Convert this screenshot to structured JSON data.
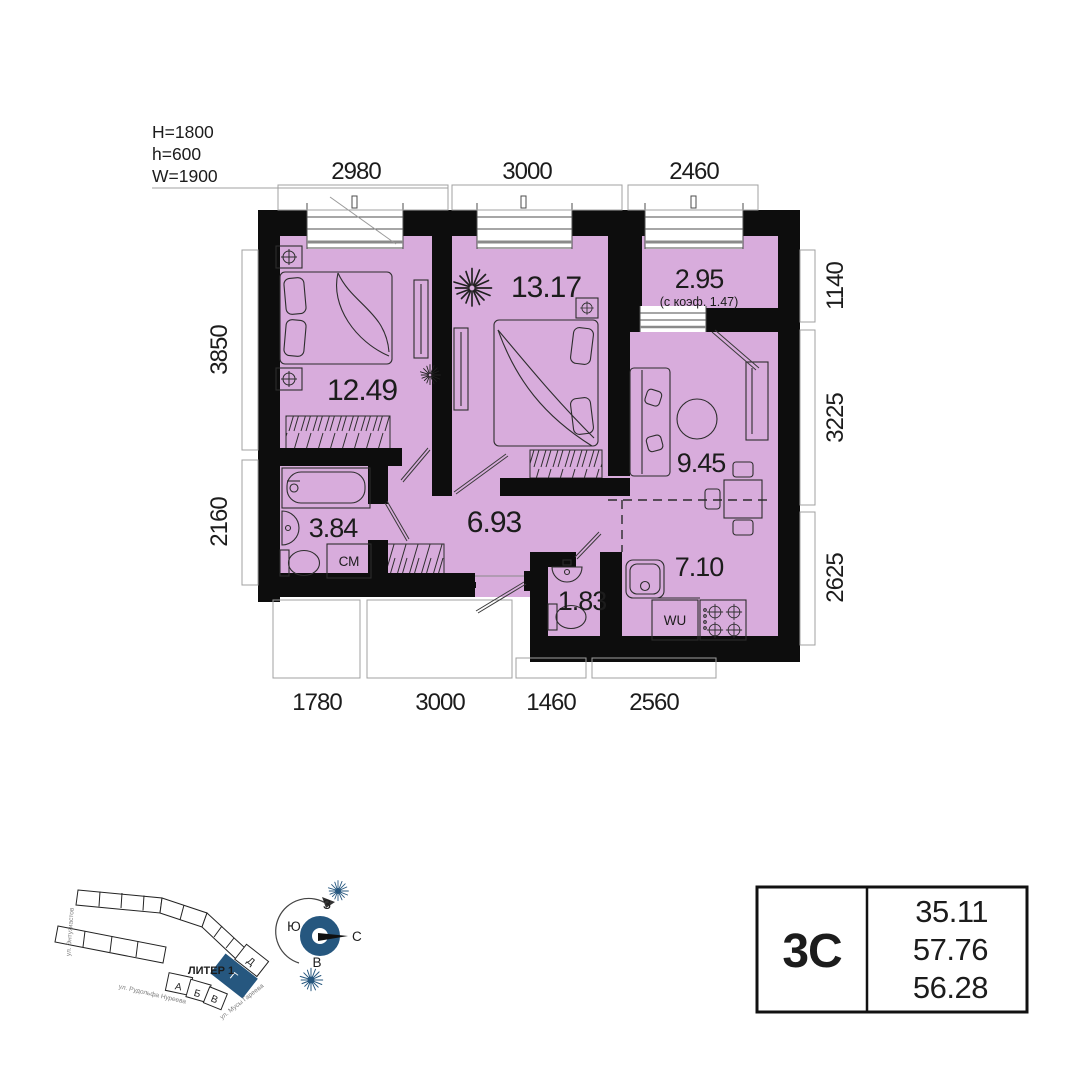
{
  "window_specs": {
    "l1": "H=1800",
    "l2": "h=600",
    "l3": "W=1900"
  },
  "dims": {
    "top": [
      "2980",
      "3000",
      "2460"
    ],
    "bottom": [
      "1780",
      "3000",
      "1460",
      "2560"
    ],
    "left": [
      "3850",
      "2160"
    ],
    "right": [
      "1140",
      "3225",
      "2625"
    ]
  },
  "rooms": {
    "bedroom1": {
      "area": "12.49"
    },
    "bedroom2": {
      "area": "13.17"
    },
    "balcony": {
      "area": "2.95",
      "note": "(с коэф. 1.47)"
    },
    "living": {
      "area": "9.45"
    },
    "hall": {
      "area": "6.93"
    },
    "bathroom": {
      "area": "3.84",
      "appliance": "СМ"
    },
    "wc": {
      "area": "1.83"
    },
    "kitchen": {
      "area": "7.10",
      "appliance": "WU"
    }
  },
  "info_table": {
    "unit_type": "3С",
    "values": [
      "35.11",
      "57.76",
      "56.28"
    ]
  },
  "site_plan": {
    "title": "ЛИТЕР 1",
    "blocks": [
      "А",
      "Б",
      "В",
      "Г",
      "Д"
    ],
    "highlighted_block": "Г",
    "streets": [
      "ул. Энтузиастов",
      "ул. Рудольфа Нуреева",
      "ул. Мусы Гареева"
    ],
    "compass": {
      "top": "З",
      "left": "Ю",
      "right": "С",
      "bottom": "В"
    }
  },
  "colors": {
    "room_fill": "#d8acdc",
    "wall": "#0d0d0d",
    "accent_blue": "#26577f"
  }
}
